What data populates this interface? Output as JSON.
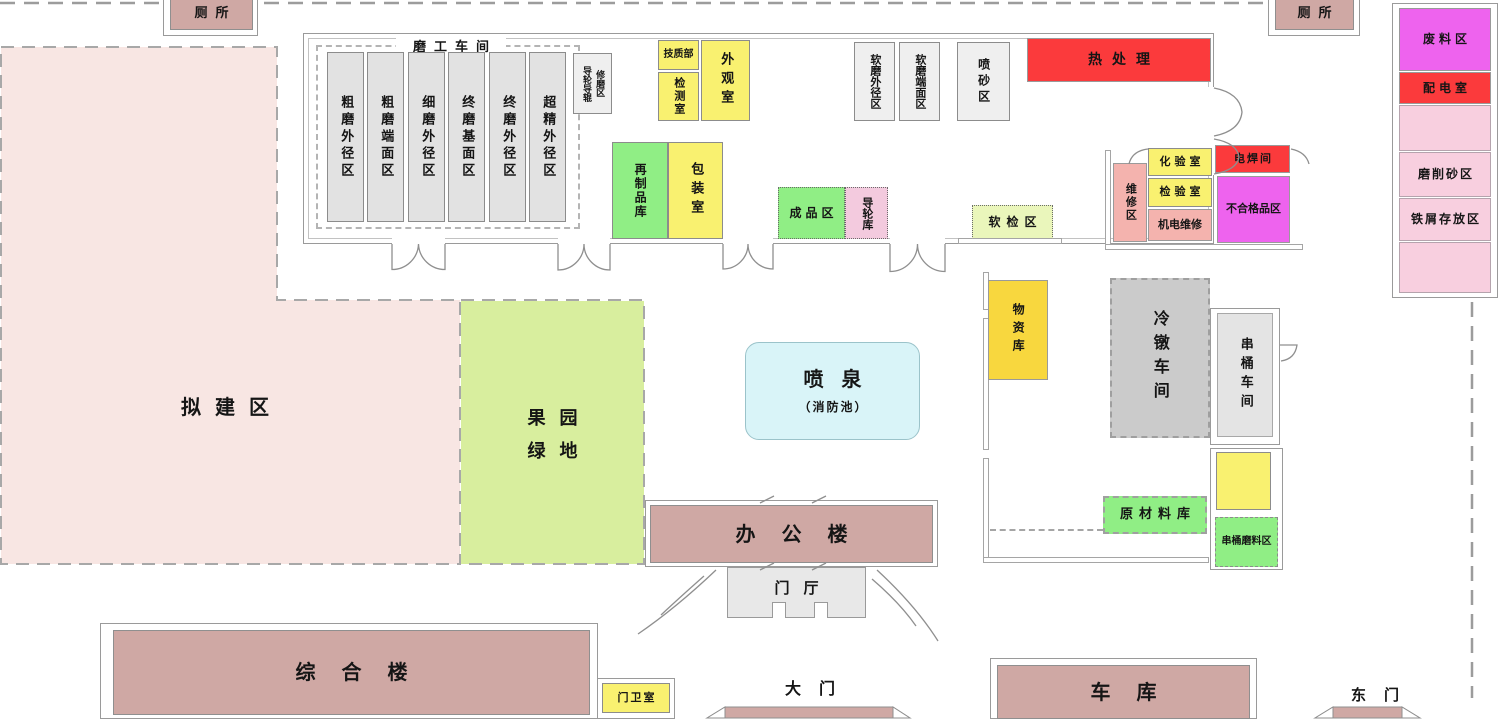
{
  "colors": {
    "building_pink": "#cfa8a4",
    "planned_pink": "#f8e6e3",
    "orchard_green": "#d8ee9e",
    "room_yellow": "#f9f170",
    "zone_green": "#90ee85",
    "alert_red": "#fb3a3c",
    "magenta": "#ee63ee",
    "light_pink": "#f8cfdf",
    "salmon_pink": "#f4b3ae",
    "gold_yellow": "#f8d73e",
    "machine_gray": "#e2e2e2",
    "fountain_cyan": "#d9f4f8",
    "guide_store_pink": "#f3cade",
    "soft_check_green": "#eaf6bb",
    "wall_gray": "#a5a5a5"
  },
  "site": {
    "toilet_left": "厕所",
    "toilet_right": "厕所",
    "planned_area": "拟建区",
    "orchard_line1": "果园",
    "orchard_line2": "绿地",
    "fountain_title": "喷泉",
    "fountain_sub": "（消防池）",
    "office_building": "办公楼",
    "lobby": "门厅",
    "complex_building": "综合楼",
    "guard_room": "门卫室",
    "main_gate": "大门",
    "garage": "车库",
    "east_gate": "东门"
  },
  "workshop": {
    "title": "磨工车间",
    "columns": [
      {
        "label": "粗磨外径区"
      },
      {
        "label": "粗磨端面区"
      },
      {
        "label": "细磨外径区"
      },
      {
        "label": "终磨基面区"
      },
      {
        "label": "终磨外径区"
      },
      {
        "label": "超精外径区"
      }
    ],
    "regrind_col1": "导轮导辊",
    "regrind_col2": "修磨区",
    "tech_dept": "技质部",
    "testing_room": "检测室",
    "appearance_room": "外观室",
    "soft_grind_od": "软磨外径区",
    "soft_grind_face": "软磨端面区",
    "sandblast_zone": "喷砂区",
    "heat_treatment": "热处理",
    "remade_store": "再制品库",
    "packing_room": "包装室",
    "finished_zone": "成品区",
    "guide_wheel_store": "导轮库",
    "soft_check_zone": "软检区",
    "repair_zone": "维修区",
    "chem_lab": "化验室",
    "inspection_room": "检验室",
    "mech_elec_repair": "机电维修",
    "welding_room": "电焊间",
    "reject_zone": "不合格品区"
  },
  "east_zone": {
    "material_store": "物资库",
    "cold_heading_shop": "冷镦车间",
    "barrel_shop": "串桶车间",
    "raw_material_store": "原材料库",
    "barrel_abrasive_zone": "串桶磨料区"
  },
  "right_strip": {
    "waste_zone": "废料区",
    "power_room": "配电室",
    "grinding_sand_zone": "磨削砂区",
    "iron_scrap_zone": "铁屑存放区"
  }
}
